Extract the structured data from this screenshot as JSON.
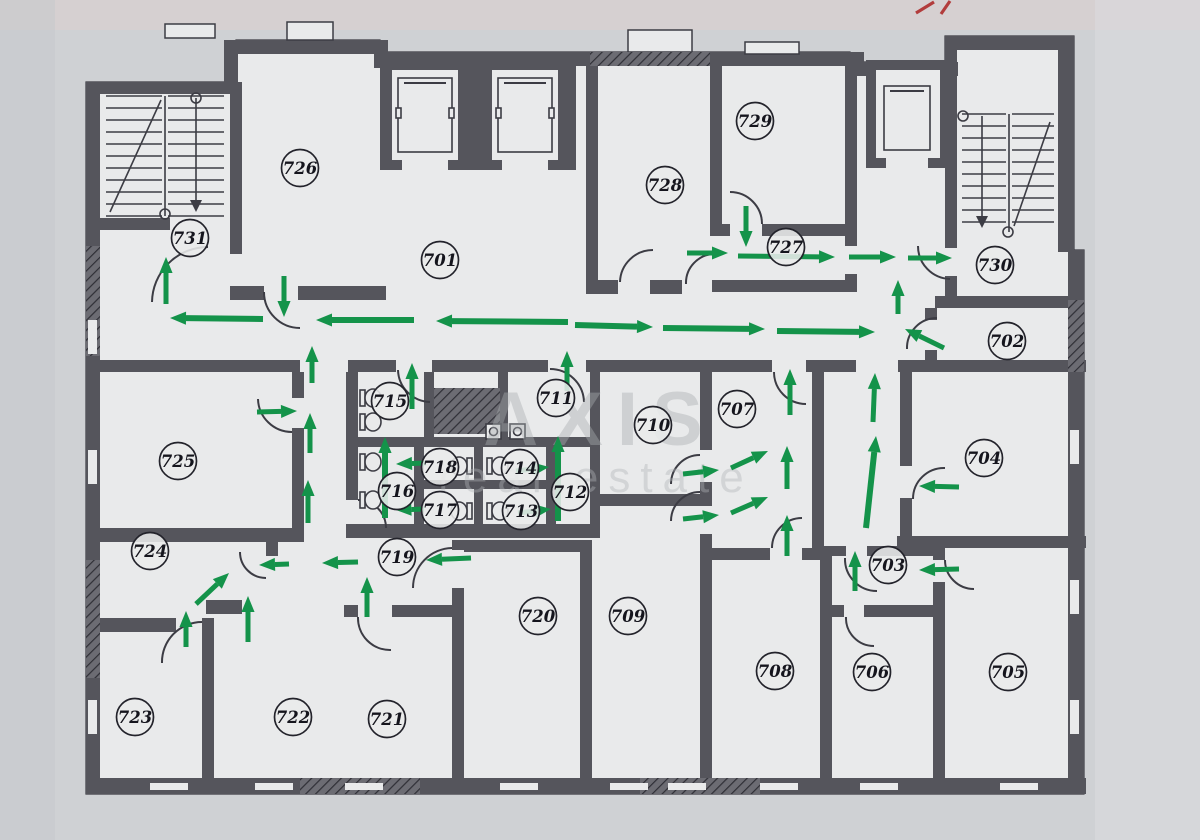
{
  "title": "Office floor evacuation plan",
  "watermark": {
    "line1": "AXIS",
    "line2": "real estate"
  },
  "colors": {
    "paper": "#cfd1d4",
    "floor": "#e9eaeb",
    "wall": "#55555c",
    "arrow_green": "#14934a",
    "label_ink": "#15151d",
    "red_mark": "#b23c3c"
  },
  "rooms": [
    {
      "n": "701",
      "x": 440,
      "y": 260
    },
    {
      "n": "702",
      "x": 1007,
      "y": 341
    },
    {
      "n": "703",
      "x": 888,
      "y": 565
    },
    {
      "n": "704",
      "x": 984,
      "y": 458
    },
    {
      "n": "705",
      "x": 1008,
      "y": 672
    },
    {
      "n": "706",
      "x": 872,
      "y": 672
    },
    {
      "n": "707",
      "x": 737,
      "y": 409
    },
    {
      "n": "708",
      "x": 775,
      "y": 671
    },
    {
      "n": "709",
      "x": 628,
      "y": 616
    },
    {
      "n": "710",
      "x": 653,
      "y": 425
    },
    {
      "n": "711",
      "x": 556,
      "y": 398
    },
    {
      "n": "712",
      "x": 570,
      "y": 492
    },
    {
      "n": "713",
      "x": 521,
      "y": 511
    },
    {
      "n": "714",
      "x": 520,
      "y": 468
    },
    {
      "n": "715",
      "x": 390,
      "y": 401
    },
    {
      "n": "716",
      "x": 397,
      "y": 491
    },
    {
      "n": "717",
      "x": 440,
      "y": 510
    },
    {
      "n": "718",
      "x": 440,
      "y": 467
    },
    {
      "n": "719",
      "x": 397,
      "y": 557
    },
    {
      "n": "720",
      "x": 538,
      "y": 616
    },
    {
      "n": "721",
      "x": 387,
      "y": 719
    },
    {
      "n": "722",
      "x": 293,
      "y": 717
    },
    {
      "n": "723",
      "x": 135,
      "y": 717
    },
    {
      "n": "724",
      "x": 150,
      "y": 551
    },
    {
      "n": "725",
      "x": 178,
      "y": 461
    },
    {
      "n": "726",
      "x": 300,
      "y": 168
    },
    {
      "n": "727",
      "x": 786,
      "y": 247
    },
    {
      "n": "728",
      "x": 665,
      "y": 185
    },
    {
      "n": "729",
      "x": 755,
      "y": 121
    },
    {
      "n": "730",
      "x": 995,
      "y": 265
    },
    {
      "n": "731",
      "x": 190,
      "y": 238
    }
  ],
  "arrows": [
    [
      263,
      319,
      170,
      318,
      6
    ],
    [
      414,
      320,
      316,
      320,
      6
    ],
    [
      568,
      322,
      436,
      321,
      6
    ],
    [
      575,
      325,
      653,
      327,
      6
    ],
    [
      663,
      328,
      765,
      329,
      6
    ],
    [
      777,
      331,
      875,
      332,
      6
    ],
    [
      166,
      304,
      166,
      257,
      5
    ],
    [
      284,
      276,
      284,
      317,
      5
    ],
    [
      746,
      206,
      746,
      247,
      5
    ],
    [
      687,
      253,
      728,
      253,
      5
    ],
    [
      738,
      256,
      835,
      257,
      5
    ],
    [
      849,
      257,
      896,
      257,
      5
    ],
    [
      908,
      258,
      952,
      258,
      5
    ],
    [
      898,
      314,
      898,
      280,
      5
    ],
    [
      944,
      348,
      905,
      329,
      5
    ],
    [
      412,
      409,
      412,
      363,
      5
    ],
    [
      567,
      391,
      567,
      351,
      5
    ],
    [
      312,
      383,
      312,
      346,
      5
    ],
    [
      310,
      453,
      310,
      413,
      5
    ],
    [
      308,
      523,
      308,
      480,
      5
    ],
    [
      257,
      412,
      297,
      411,
      5
    ],
    [
      385,
      518,
      385,
      437,
      6
    ],
    [
      558,
      521,
      558,
      436,
      6
    ],
    [
      426,
      463,
      396,
      464,
      5
    ],
    [
      424,
      509,
      396,
      510,
      5
    ],
    [
      516,
      471,
      549,
      467,
      5
    ],
    [
      518,
      513,
      551,
      509,
      5
    ],
    [
      358,
      562,
      322,
      563,
      5
    ],
    [
      471,
      558,
      426,
      560,
      5
    ],
    [
      367,
      617,
      367,
      577,
      5
    ],
    [
      289,
      564,
      259,
      565,
      5
    ],
    [
      196,
      604,
      229,
      573,
      5
    ],
    [
      186,
      647,
      186,
      611,
      5
    ],
    [
      248,
      642,
      248,
      596,
      5
    ],
    [
      683,
      474,
      719,
      470,
      5
    ],
    [
      683,
      519,
      719,
      515,
      5
    ],
    [
      731,
      468,
      768,
      451,
      5
    ],
    [
      731,
      513,
      768,
      497,
      5
    ],
    [
      787,
      489,
      787,
      446,
      5
    ],
    [
      787,
      556,
      787,
      515,
      5
    ],
    [
      790,
      415,
      790,
      369,
      5
    ],
    [
      866,
      528,
      876,
      436,
      6
    ],
    [
      873,
      422,
      875,
      373,
      5
    ],
    [
      959,
      487,
      919,
      486,
      5
    ],
    [
      959,
      569,
      919,
      570,
      5
    ],
    [
      855,
      591,
      855,
      551,
      5
    ]
  ]
}
